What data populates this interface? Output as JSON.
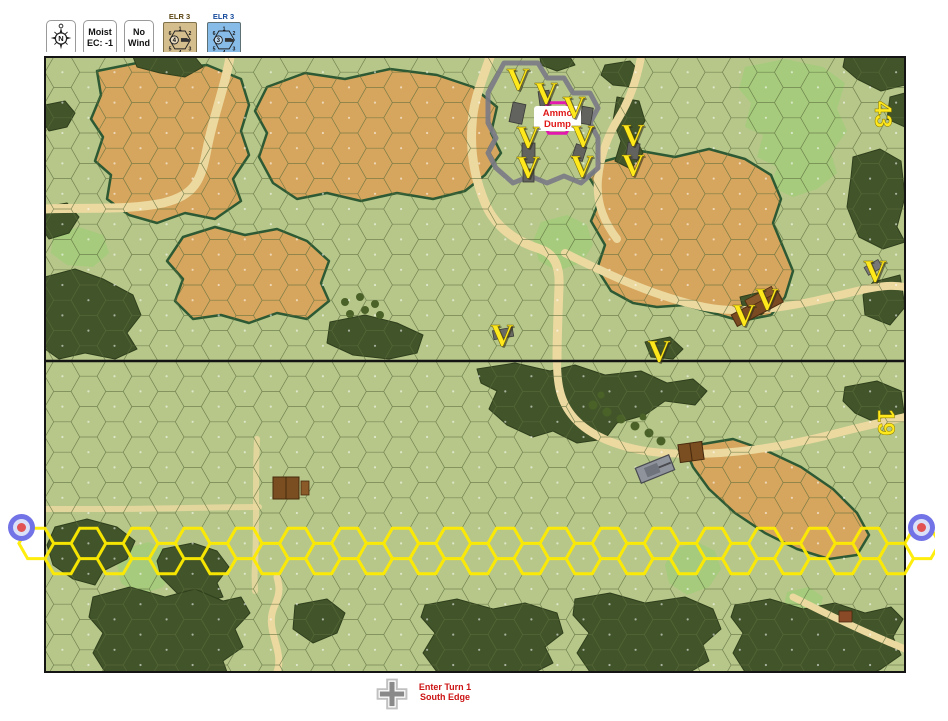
{
  "toolbar": {
    "compass_button": {
      "letter": "N"
    },
    "weather_button": {
      "line1": "Moist",
      "line2": "EC: -1"
    },
    "wind_button": {
      "line1": "No",
      "line2": "Wind"
    },
    "elr_counters": [
      {
        "label": "ELR 3",
        "center_value": "4",
        "hex_numbers": [
          "6",
          "1",
          "2",
          "5",
          "4",
          "3"
        ],
        "bg": "#d5be8d",
        "label_color": "#5a4412"
      },
      {
        "label": "ELR 3",
        "center_value": "3",
        "hex_numbers": [
          "6",
          "1",
          "2",
          "5",
          "4",
          "3"
        ],
        "bg": "#87bce9",
        "label_color": "#15499b"
      }
    ]
  },
  "map": {
    "boards": [
      {
        "number": "43"
      },
      {
        "number": "19"
      }
    ],
    "ammo_dump_label": {
      "line1": "Ammo",
      "line2": "Dump"
    },
    "victory_marker_symbol": "V",
    "victory_markers": [
      {
        "x": 473,
        "y": 22
      },
      {
        "x": 501,
        "y": 36
      },
      {
        "x": 529,
        "y": 50
      },
      {
        "x": 483,
        "y": 80
      },
      {
        "x": 538,
        "y": 79
      },
      {
        "x": 483,
        "y": 110
      },
      {
        "x": 537,
        "y": 109
      },
      {
        "x": 588,
        "y": 78
      },
      {
        "x": 588,
        "y": 108
      },
      {
        "x": 457,
        "y": 278
      },
      {
        "x": 614,
        "y": 294
      },
      {
        "x": 699,
        "y": 258
      },
      {
        "x": 722,
        "y": 242
      },
      {
        "x": 830,
        "y": 214
      }
    ],
    "grid": {
      "columns": 33,
      "hex_width": 34.74,
      "hex_height": 30.4,
      "line_color": "#5c6e3e"
    },
    "entry_row": {
      "start_col": -1,
      "end_col": 33,
      "y_even": 501.6,
      "y_odd": 486.4,
      "color": "#ffec00"
    },
    "colors": {
      "base": "#b7c78a",
      "grain": "#d7a65e",
      "woods": "#42552a",
      "brush": "#a6cb7d",
      "road": "#ecd9a0",
      "hedge": "#2d5a34",
      "wall": "#7b7b85",
      "board_number": "#ffe81c",
      "victory": "#ffe81c",
      "ammo_text": "#e01818",
      "ammo_ring": "#e318ae",
      "boundary": "#141414"
    },
    "edge_markers": [
      {
        "side": "left"
      },
      {
        "side": "right"
      }
    ]
  },
  "footer": {
    "turn_note": {
      "line1": "Enter Turn 1",
      "line2": "South Edge"
    },
    "cross_color": "#8a8a8a"
  }
}
